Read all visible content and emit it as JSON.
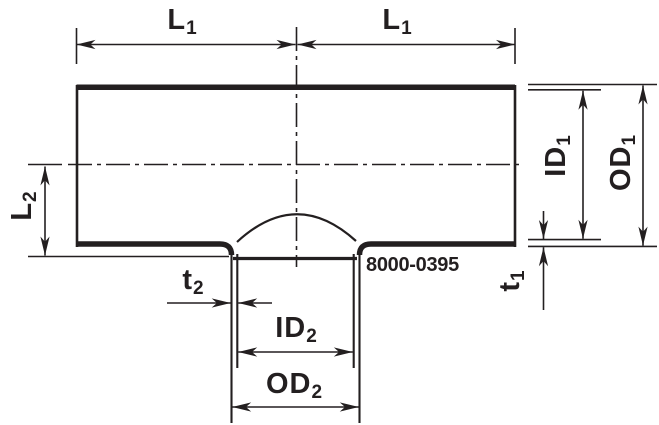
{
  "drawing": {
    "part_number": "8000-0395",
    "labels": {
      "l1_left": {
        "main": "L",
        "sub": "1"
      },
      "l1_right": {
        "main": "L",
        "sub": "1"
      },
      "l2": {
        "main": "L",
        "sub": "2"
      },
      "id1": {
        "main": "ID",
        "sub": "1"
      },
      "od1": {
        "main": "OD",
        "sub": "1"
      },
      "t1": {
        "main": "t",
        "sub": "1"
      },
      "t2": {
        "main": "t",
        "sub": "2"
      },
      "id2": {
        "main": "ID",
        "sub": "2"
      },
      "od2": {
        "main": "OD",
        "sub": "2"
      }
    },
    "colors": {
      "line": "#231f20",
      "background": "#ffffff"
    }
  }
}
